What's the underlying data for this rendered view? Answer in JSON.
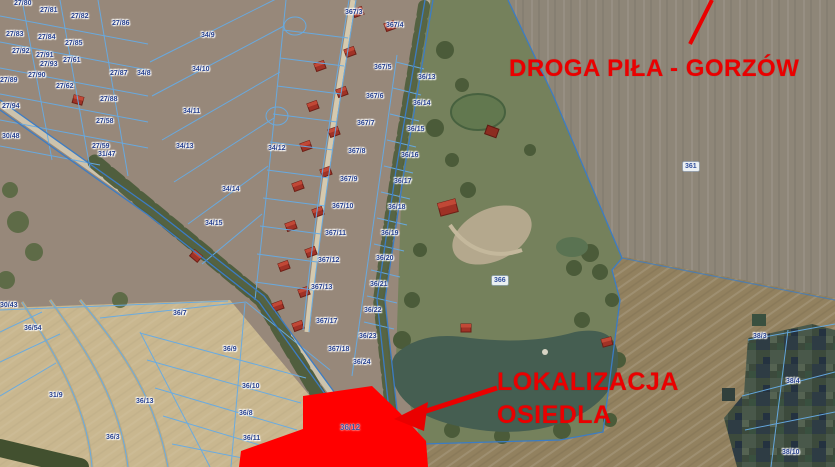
{
  "map": {
    "annotations": {
      "road_label": "DROGA PIŁA - GORZÓW",
      "location_label_line1": "LOKALIZACJA",
      "location_label_line2": "OSIEDLA"
    },
    "colors": {
      "annotation_red": "#ea0000",
      "highlight_parcel_fill": "#ff0000",
      "cadastral_line_blue": "#66abe4",
      "road_line_blue": "#3c7cc4",
      "parcel_text_blue": "#243e8c"
    },
    "parcel_labels": [
      {
        "text": "27/80",
        "x": 14,
        "y": 0
      },
      {
        "text": "27/81",
        "x": 40,
        "y": 7
      },
      {
        "text": "27/82",
        "x": 71,
        "y": 13
      },
      {
        "text": "27/86",
        "x": 112,
        "y": 20
      },
      {
        "text": "27/83",
        "x": 6,
        "y": 31
      },
      {
        "text": "27/84",
        "x": 38,
        "y": 34
      },
      {
        "text": "27/85",
        "x": 65,
        "y": 40
      },
      {
        "text": "27/92",
        "x": 12,
        "y": 48
      },
      {
        "text": "27/91",
        "x": 36,
        "y": 52
      },
      {
        "text": "27/61",
        "x": 63,
        "y": 57
      },
      {
        "text": "27/93",
        "x": 40,
        "y": 61
      },
      {
        "text": "27/87",
        "x": 110,
        "y": 70
      },
      {
        "text": "27/90",
        "x": 28,
        "y": 72
      },
      {
        "text": "27/89",
        "x": 0,
        "y": 77
      },
      {
        "text": "27/62",
        "x": 56,
        "y": 83
      },
      {
        "text": "27/88",
        "x": 100,
        "y": 96
      },
      {
        "text": "27/94",
        "x": 2,
        "y": 103
      },
      {
        "text": "27/58",
        "x": 96,
        "y": 118
      },
      {
        "text": "30/48",
        "x": 2,
        "y": 133
      },
      {
        "text": "27/59",
        "x": 92,
        "y": 143
      },
      {
        "text": "31/47",
        "x": 98,
        "y": 151
      },
      {
        "text": "34/8",
        "x": 137,
        "y": 70
      },
      {
        "text": "34/9",
        "x": 201,
        "y": 32
      },
      {
        "text": "34/10",
        "x": 192,
        "y": 66
      },
      {
        "text": "34/11",
        "x": 183,
        "y": 108
      },
      {
        "text": "34/12",
        "x": 268,
        "y": 145
      },
      {
        "text": "34/13",
        "x": 176,
        "y": 143
      },
      {
        "text": "34/14",
        "x": 222,
        "y": 186
      },
      {
        "text": "34/15",
        "x": 205,
        "y": 220
      },
      {
        "text": "367/3",
        "x": 345,
        "y": 9
      },
      {
        "text": "367/4",
        "x": 386,
        "y": 22
      },
      {
        "text": "367/5",
        "x": 374,
        "y": 64
      },
      {
        "text": "367/6",
        "x": 366,
        "y": 93
      },
      {
        "text": "367/7",
        "x": 357,
        "y": 120
      },
      {
        "text": "367/8",
        "x": 348,
        "y": 148
      },
      {
        "text": "367/9",
        "x": 340,
        "y": 176
      },
      {
        "text": "367/10",
        "x": 332,
        "y": 203
      },
      {
        "text": "367/11",
        "x": 325,
        "y": 230
      },
      {
        "text": "367/12",
        "x": 318,
        "y": 257
      },
      {
        "text": "367/13",
        "x": 311,
        "y": 284
      },
      {
        "text": "367/17",
        "x": 316,
        "y": 318
      },
      {
        "text": "367/18",
        "x": 328,
        "y": 346
      },
      {
        "text": "36/13",
        "x": 418,
        "y": 74
      },
      {
        "text": "36/14",
        "x": 413,
        "y": 100
      },
      {
        "text": "36/15",
        "x": 407,
        "y": 126
      },
      {
        "text": "36/16",
        "x": 401,
        "y": 152
      },
      {
        "text": "36/17",
        "x": 394,
        "y": 178
      },
      {
        "text": "36/18",
        "x": 388,
        "y": 204
      },
      {
        "text": "36/19",
        "x": 381,
        "y": 230
      },
      {
        "text": "36/20",
        "x": 376,
        "y": 255
      },
      {
        "text": "36/21",
        "x": 370,
        "y": 281
      },
      {
        "text": "36/22",
        "x": 364,
        "y": 307
      },
      {
        "text": "36/23",
        "x": 359,
        "y": 333
      },
      {
        "text": "36/24",
        "x": 353,
        "y": 359
      },
      {
        "text": "361",
        "x": 683,
        "y": 162,
        "chip": true
      },
      {
        "text": "366",
        "x": 492,
        "y": 276,
        "chip": true
      },
      {
        "text": "30/43",
        "x": 0,
        "y": 302
      },
      {
        "text": "36/54",
        "x": 24,
        "y": 325
      },
      {
        "text": "36/7",
        "x": 173,
        "y": 310
      },
      {
        "text": "31/9",
        "x": 49,
        "y": 392
      },
      {
        "text": "36/13",
        "x": 136,
        "y": 398
      },
      {
        "text": "36/9",
        "x": 223,
        "y": 346
      },
      {
        "text": "36/10",
        "x": 242,
        "y": 383
      },
      {
        "text": "36/8",
        "x": 239,
        "y": 410
      },
      {
        "text": "36/11",
        "x": 243,
        "y": 435
      },
      {
        "text": "36/3",
        "x": 106,
        "y": 434
      },
      {
        "text": "38/3",
        "x": 753,
        "y": 333
      },
      {
        "text": "38/4",
        "x": 786,
        "y": 378
      },
      {
        "text": "38/10",
        "x": 782,
        "y": 449
      },
      {
        "text": "36/12",
        "x": 340,
        "y": 424,
        "on_red": true
      }
    ]
  }
}
